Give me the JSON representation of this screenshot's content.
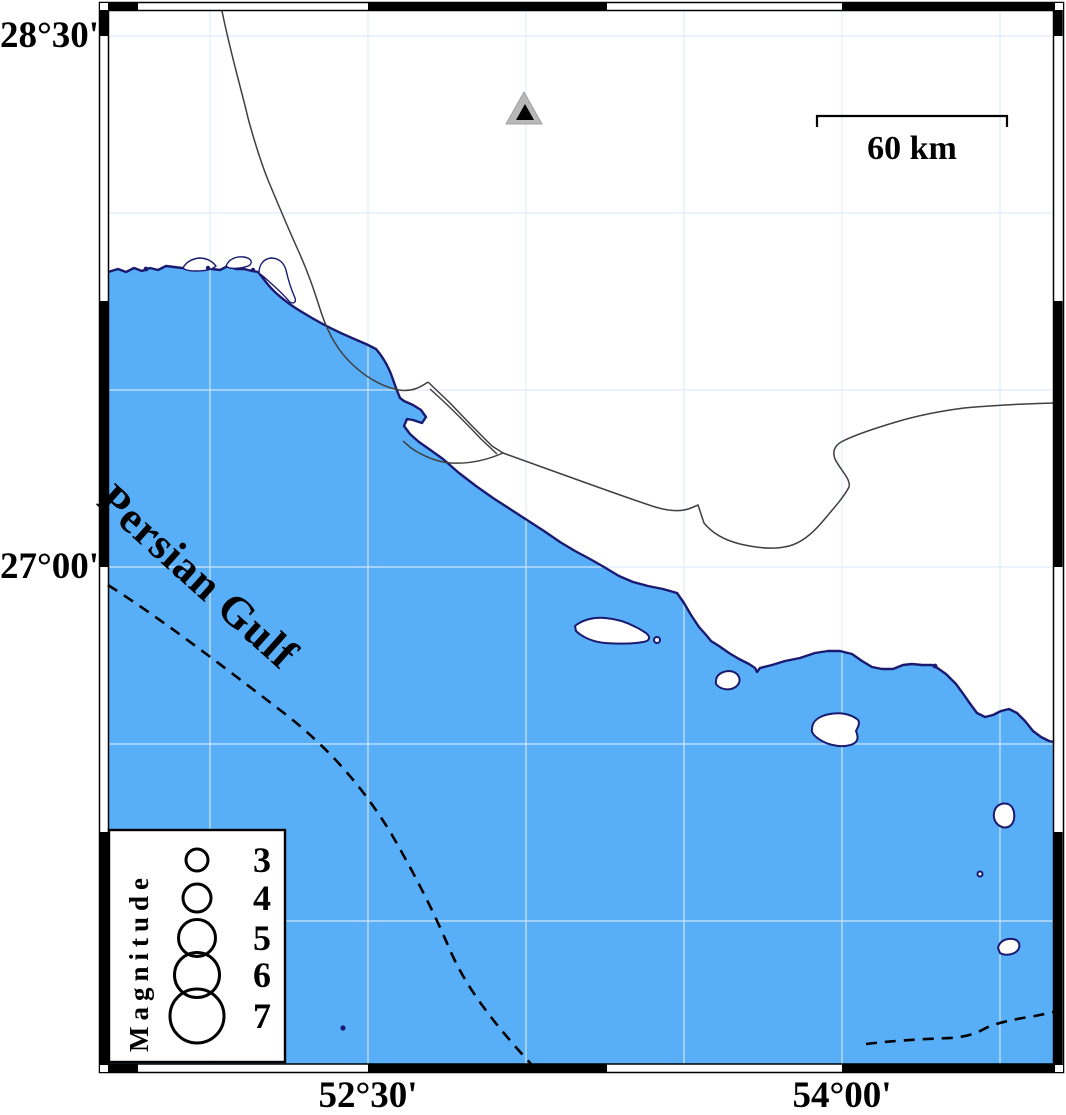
{
  "figure": {
    "type": "seismicity-map",
    "region_label": "Persian Gulf",
    "scale_bar": {
      "label": "60 km"
    },
    "station_marker": {
      "shape": "triangle",
      "outer_color": "#b8b8b8",
      "inner_color": "#000000"
    },
    "axes": {
      "lat_labels": [
        {
          "text": "28°30'"
        },
        {
          "text": "27°00'"
        }
      ],
      "lon_labels": [
        {
          "text": "52°30'"
        },
        {
          "text": "54°00'"
        }
      ]
    },
    "legend": {
      "title": "Magnitude",
      "entries": [
        {
          "label": "3",
          "cy": "860",
          "r": "11"
        },
        {
          "label": "4",
          "cy": "898",
          "r": "14"
        },
        {
          "label": "5",
          "cy": "938",
          "r": "18.5"
        },
        {
          "label": "6",
          "cy": "975",
          "r": "22.5"
        },
        {
          "label": "7",
          "cy": "1016",
          "r": "27"
        }
      ]
    },
    "colors": {
      "sea": "#58AFF8",
      "coastline": "#1a1a70",
      "land": "#ffffff",
      "graticule": "#dcebfa",
      "boundary_dash": "#000000"
    }
  }
}
